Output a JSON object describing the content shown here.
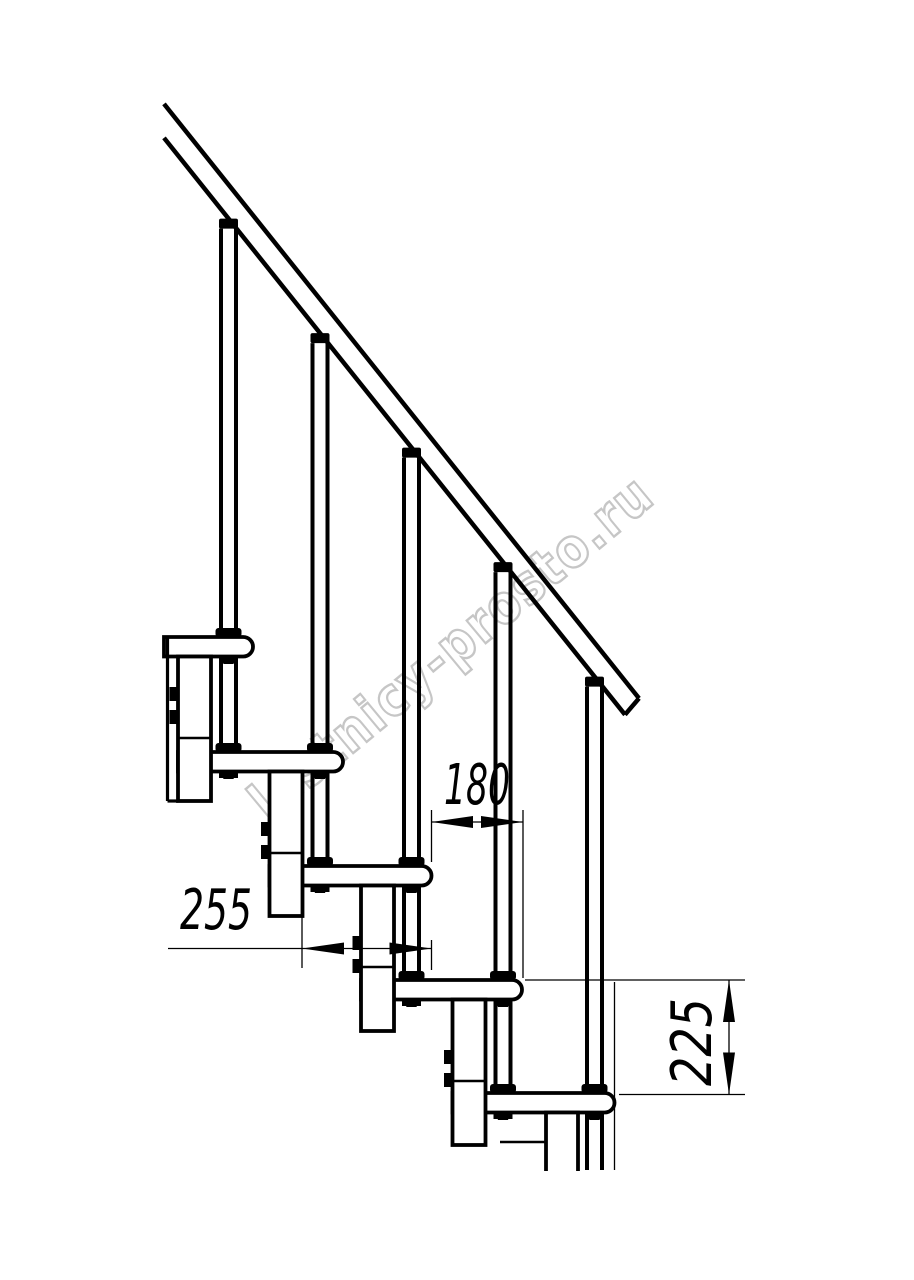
{
  "drawing": {
    "title": "Modular staircase side elevation drawing",
    "type": "technical-line-drawing"
  },
  "dimensions": {
    "baluster_spacing": "180",
    "step_run": "255",
    "step_rise": "225"
  },
  "watermark": {
    "text": "lestnicy-prosto.ru",
    "color": "#c6c6c6"
  },
  "colors": {
    "line": "#000000",
    "background": "#ffffff",
    "thin_line": "#000000"
  }
}
